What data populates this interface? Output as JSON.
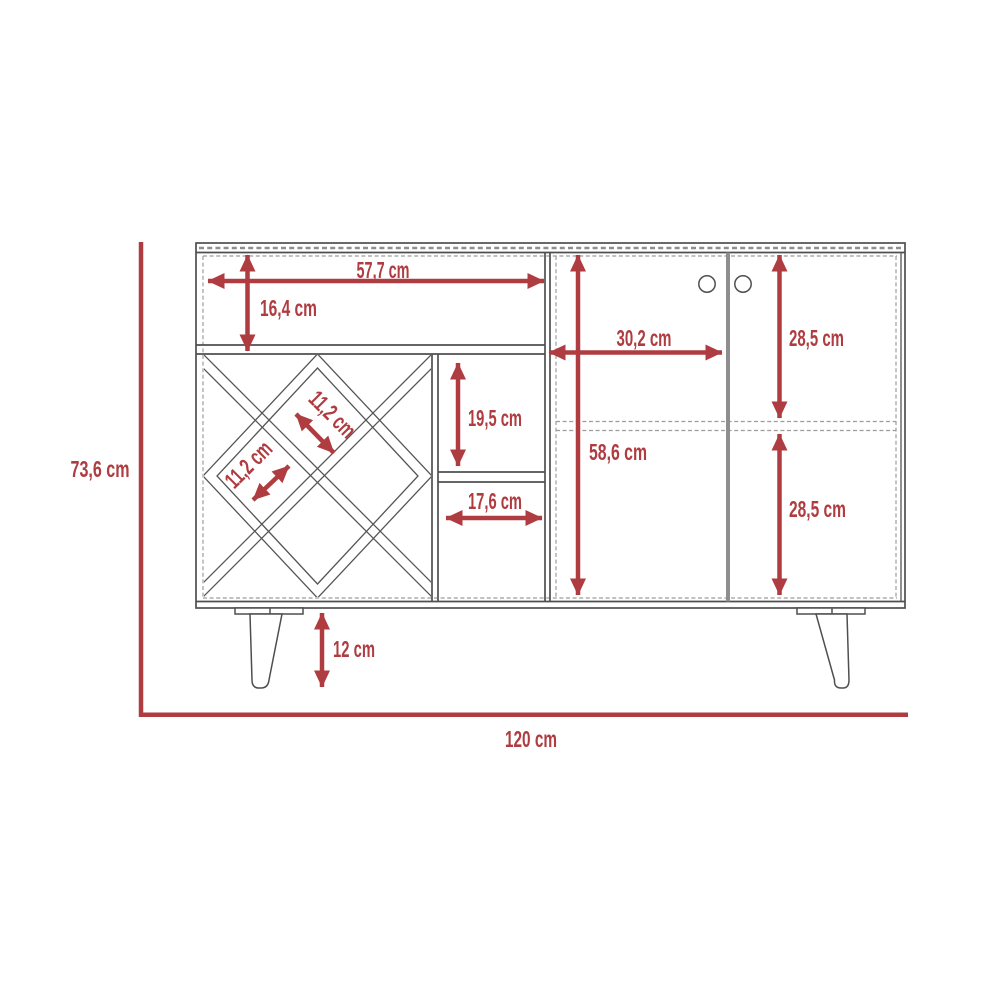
{
  "drawing": {
    "kind": "furniture-technical-drawing",
    "unit": "cm"
  },
  "colors": {
    "dimension_red": "#af3c40",
    "cabinet_line": "#4f4f4f",
    "dashed_line": "#9c9c9c",
    "door_divider_gray": "#8e8e8e",
    "background": "#ffffff"
  },
  "dims": {
    "overall_height": "73,6 cm",
    "overall_width": "120 cm",
    "shelf_width": "57,7 cm",
    "shelf_height": "16,4 cm",
    "cubby_height": "19,5 cm",
    "cubby_width": "17,6 cm",
    "wine_slot_a": "11,2 cm",
    "wine_slot_b": "11,2 cm",
    "door_width": "30,2 cm",
    "door_top_height": "28,5 cm",
    "interior_height": "58,6 cm",
    "door_bottom_height": "28,5 cm",
    "leg_height": "12 cm"
  }
}
